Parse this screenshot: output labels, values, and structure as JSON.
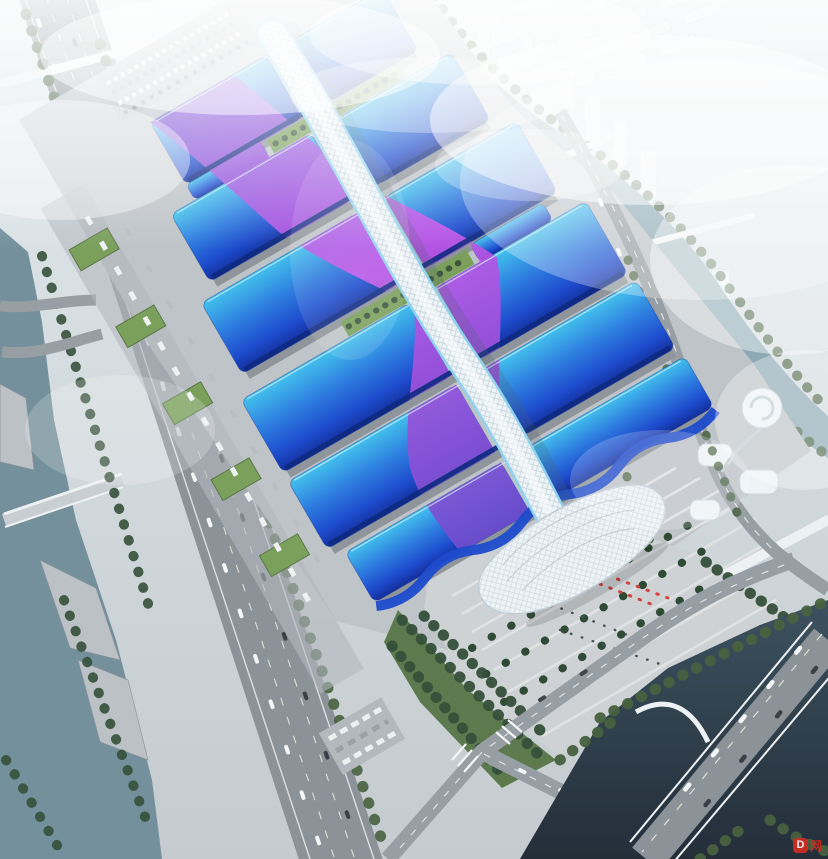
{
  "image": {
    "title": "Aerial rendering of a riverside exhibition and convention center",
    "description": "Bird's-eye architectural visualization of a mega exhibition complex: two columns of wavy blue exhibition halls flank a sinuous white lattice spine corridor, crossed by a purple-magenta ribbon motif. A white shell entrance hall sits at the south end facing a striped palm plaza with red flags. The site is bordered by a diagonal highway and canal on the west, a winding river and hazy white city blocks to the north and east, and a dark river with a road bridge at the south-east corner.",
    "style": "photoreal daylight render with heavy white haze",
    "watermark_badge": "D",
    "watermark_text": "网"
  },
  "palette": {
    "sky_top": "#e3ebee",
    "sky_mid": "#d4dcdf",
    "sky_low": "#c5cbcf",
    "city": "#eef3f5",
    "city_shade": "#c8d3d8",
    "water_river": "#8ea9b5",
    "water_canal": "#73909c",
    "water_dark_top": "#3c515f",
    "water_dark_bot": "#232e39",
    "road": "#989fa4",
    "highway": "#8c9398",
    "road_line": "#f2f4f5",
    "apron": "#bfc4c8",
    "plaza": "#ced2d4",
    "plaza_stripe": "#e2e4e5",
    "tree": "#47613f",
    "tree_dark": "#36503a",
    "palm": "#2f4a35",
    "lawn": "#7aa05c",
    "roof_cyan": "#43c2ec",
    "roof_azure": "#2e7de0",
    "roof_blue": "#1d4bcc",
    "roof_navy": "#132e9a",
    "eave_navy": "#0e2a80",
    "wall_grey": "#8f959a",
    "ribbon_top": "#8a55d8",
    "ribbon_mid": "#c355e8",
    "ribbon_bot": "#6b4ecb",
    "spine_white": "#edf3f6",
    "spine_trim": "#8fd3ee",
    "lattice": "#a9bcc9",
    "shell_white": "#eef3f6",
    "shell_line": "#c9d4da",
    "bridge_white": "#eef1f3",
    "flag_red": "#d2453f",
    "people": "#4a5056",
    "watermark_red": "#d42b1f"
  }
}
